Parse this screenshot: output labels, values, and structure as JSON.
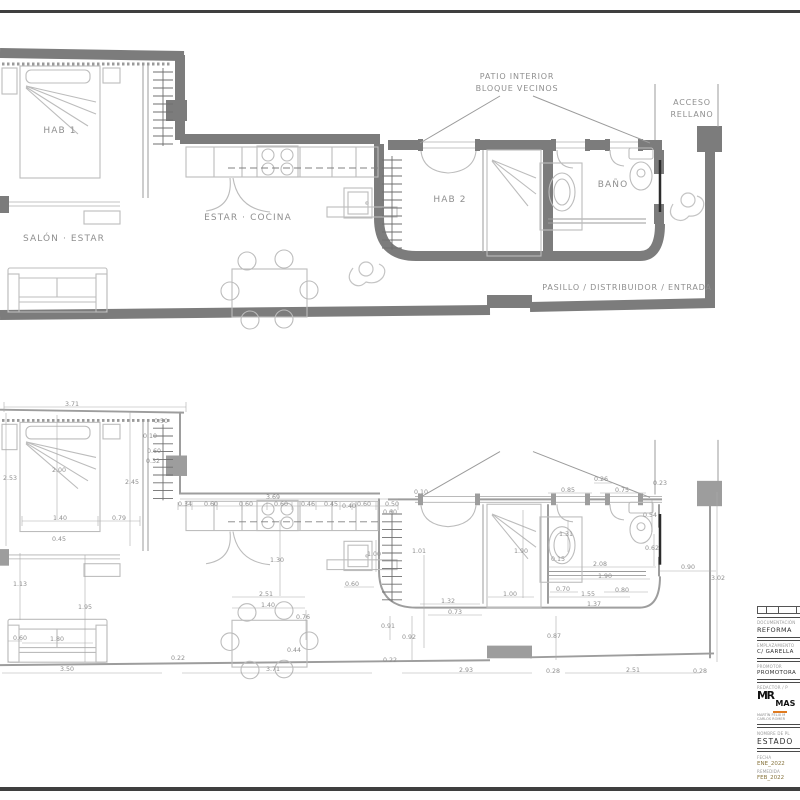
{
  "top_plan": {
    "labels": {
      "hab1": "HAB 1",
      "salon": "SALÓN · ESTAR",
      "cocina": "ESTAR · COCINA",
      "hab2": "HAB 2",
      "bano": "BAÑO",
      "pasillo": "PASILLO / DISTRIBUIDOR / ENTRADA",
      "patio_line1": "PATIO INTERIOR",
      "patio_line2": "BLOQUE VECINOS",
      "acceso_line1": "ACCESO",
      "acceso_line2": "RELLANO"
    }
  },
  "bottom_plan": {
    "dimensions": [
      {
        "v": "3.71",
        "x": 72,
        "y": 406
      },
      {
        "v": "2.53",
        "x": 10,
        "y": 480
      },
      {
        "v": "2.00",
        "x": 59,
        "y": 472
      },
      {
        "v": "2.45",
        "x": 132,
        "y": 484
      },
      {
        "v": "0.50",
        "x": 161,
        "y": 423
      },
      {
        "v": "0.10",
        "x": 150,
        "y": 438
      },
      {
        "v": "0.60",
        "x": 154,
        "y": 453
      },
      {
        "v": "0.32",
        "x": 153,
        "y": 463
      },
      {
        "v": "1.40",
        "x": 60,
        "y": 520
      },
      {
        "v": "0.79",
        "x": 119,
        "y": 520
      },
      {
        "v": "0.45",
        "x": 59,
        "y": 541
      },
      {
        "v": "0.34",
        "x": 185,
        "y": 506
      },
      {
        "v": "0.60",
        "x": 211,
        "y": 506
      },
      {
        "v": "0.60",
        "x": 246,
        "y": 506
      },
      {
        "v": "3.69",
        "x": 273,
        "y": 499
      },
      {
        "v": "0.60",
        "x": 281,
        "y": 506
      },
      {
        "v": "0.46",
        "x": 308,
        "y": 506
      },
      {
        "v": "0.45",
        "x": 331,
        "y": 506
      },
      {
        "v": "0.40",
        "x": 349,
        "y": 508
      },
      {
        "v": "0.60",
        "x": 364,
        "y": 506
      },
      {
        "v": "0.50",
        "x": 392,
        "y": 506
      },
      {
        "v": "0.60",
        "x": 390,
        "y": 514
      },
      {
        "v": "0.10",
        "x": 421,
        "y": 494
      },
      {
        "v": "1.00",
        "x": 374,
        "y": 556
      },
      {
        "v": "0.60",
        "x": 352,
        "y": 586
      },
      {
        "v": "1.01",
        "x": 419,
        "y": 553
      },
      {
        "v": "1.90",
        "x": 521,
        "y": 553
      },
      {
        "v": "0.26",
        "x": 601,
        "y": 481
      },
      {
        "v": "0.23",
        "x": 660,
        "y": 485
      },
      {
        "v": "0.85",
        "x": 568,
        "y": 492
      },
      {
        "v": "0.75",
        "x": 622,
        "y": 492
      },
      {
        "v": "1.31",
        "x": 566,
        "y": 536
      },
      {
        "v": "0.15",
        "x": 558,
        "y": 561
      },
      {
        "v": "0.54",
        "x": 650,
        "y": 517
      },
      {
        "v": "0.62",
        "x": 652,
        "y": 550
      },
      {
        "v": "2.08",
        "x": 600,
        "y": 566
      },
      {
        "v": "1.90",
        "x": 605,
        "y": 578
      },
      {
        "v": "0.70",
        "x": 563,
        "y": 591
      },
      {
        "v": "1.55",
        "x": 588,
        "y": 596
      },
      {
        "v": "0.80",
        "x": 622,
        "y": 592
      },
      {
        "v": "1.37",
        "x": 594,
        "y": 606
      },
      {
        "v": "1.32",
        "x": 448,
        "y": 603
      },
      {
        "v": "0.73",
        "x": 455,
        "y": 614
      },
      {
        "v": "1.00",
        "x": 510,
        "y": 596
      },
      {
        "v": "0.90",
        "x": 688,
        "y": 569
      },
      {
        "v": "3.02",
        "x": 718,
        "y": 580
      },
      {
        "v": "0.87",
        "x": 554,
        "y": 638
      },
      {
        "v": "0.92",
        "x": 409,
        "y": 639
      },
      {
        "v": "0.91",
        "x": 388,
        "y": 628
      },
      {
        "v": "2.93",
        "x": 466,
        "y": 672
      },
      {
        "v": "0.28",
        "x": 553,
        "y": 673
      },
      {
        "v": "2.51",
        "x": 633,
        "y": 672
      },
      {
        "v": "0.28",
        "x": 700,
        "y": 673
      },
      {
        "v": "0.22",
        "x": 390,
        "y": 662
      },
      {
        "v": "1.30",
        "x": 277,
        "y": 562
      },
      {
        "v": "2.51",
        "x": 266,
        "y": 596
      },
      {
        "v": "1.40",
        "x": 268,
        "y": 607
      },
      {
        "v": "0.76",
        "x": 303,
        "y": 619
      },
      {
        "v": "0.44",
        "x": 294,
        "y": 652
      },
      {
        "v": "1.13",
        "x": 20,
        "y": 586
      },
      {
        "v": "1.95",
        "x": 85,
        "y": 609
      },
      {
        "v": "0.60",
        "x": 20,
        "y": 640
      },
      {
        "v": "1.80",
        "x": 57,
        "y": 641
      },
      {
        "v": "3.50",
        "x": 67,
        "y": 671
      },
      {
        "v": "0.22",
        "x": 178,
        "y": 660
      },
      {
        "v": "3.71",
        "x": 273,
        "y": 671
      }
    ]
  },
  "title_block": {
    "rows": {
      "documentacion": {
        "label": "DOCUMENTACIÓN",
        "value": "REFORMA"
      },
      "emplazamiento": {
        "label": "EMPLAZAMIENTO",
        "value": "C/ GARELLA"
      },
      "promotor": {
        "label": "PROMOTOR",
        "value": "PROMOTORA"
      },
      "redactor": {
        "label": "REDACTOR / P",
        "logo_mr": "MR",
        "logo_mas": "MAS",
        "name1": "MARTÍN FÉLIX M",
        "name2": "CARLOS ROMER"
      },
      "plano": {
        "label": "NOMBRE DE PL",
        "value": "ESTADO"
      },
      "fecha": {
        "label": "FECHA",
        "value": "ENE_2022"
      },
      "remedida": {
        "label": "REMEDIDA",
        "value": "FEB_2022"
      }
    }
  },
  "colors": {
    "wall_heavy": "#7c7c7c",
    "wall_light": "#9d9d9d",
    "accent_orange": "#e07b20",
    "date_olive": "#87743d",
    "border": "#3f3f3f"
  }
}
